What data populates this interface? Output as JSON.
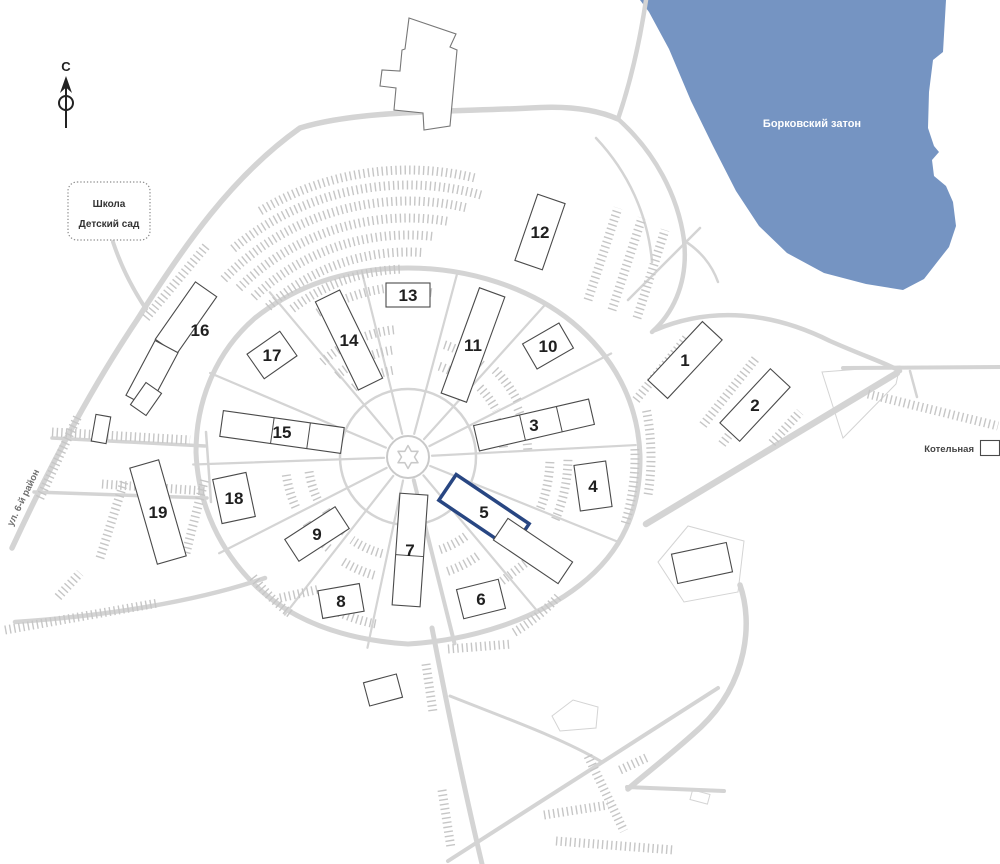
{
  "map": {
    "labels": {
      "water": "Борковский затон",
      "school_line1": "Школа",
      "school_line2": "Детский сад",
      "street": "ул. 6-й район",
      "boiler": "Котельная",
      "compass_north": "С"
    },
    "colors": {
      "water": "#7594c2",
      "road": "#d4d4d4",
      "parking": "#c6c6c6",
      "building_outline": "#4a4a4a",
      "highlight": "#284682",
      "number_text": "#1f1f1f",
      "water_label_text": "#ffffff"
    },
    "highlighted_building": "5",
    "buildings": [
      {
        "num": "1",
        "cx": 685,
        "cy": 360,
        "w": 80,
        "h": 27,
        "rot": -47
      },
      {
        "num": "2",
        "cx": 755,
        "cy": 405,
        "w": 74,
        "h": 27,
        "rot": -47
      },
      {
        "num": "3",
        "cx": 534,
        "cy": 425,
        "w": 118,
        "h": 26,
        "rot": -13,
        "segs": [
          0.4,
          0.72
        ]
      },
      {
        "num": "4",
        "cx": 593,
        "cy": 486,
        "w": 32,
        "h": 46,
        "rot": -8
      },
      {
        "num": "5",
        "cx": 484,
        "cy": 512,
        "w": 88,
        "h": 31,
        "rot": 34,
        "highlight": true
      },
      {
        "num": "",
        "cx": 533,
        "cy": 551,
        "w": 78,
        "h": 26,
        "rot": 34
      },
      {
        "num": "6",
        "cx": 481,
        "cy": 599,
        "w": 43,
        "h": 30,
        "rot": -14
      },
      {
        "num": "7",
        "cx": 410,
        "cy": 550,
        "w": 28,
        "h": 112,
        "rot": 4,
        "segsv": [
          0.55
        ]
      },
      {
        "num": "8",
        "cx": 341,
        "cy": 601,
        "w": 42,
        "h": 28,
        "rot": -10
      },
      {
        "num": "9",
        "cx": 317,
        "cy": 534,
        "w": 60,
        "h": 26,
        "rot": -33
      },
      {
        "num": "10",
        "cx": 548,
        "cy": 346,
        "w": 42,
        "h": 29,
        "rot": -30
      },
      {
        "num": "11",
        "cx": 473,
        "cy": 345,
        "w": 27,
        "h": 112,
        "rot": 20
      },
      {
        "num": "12",
        "cx": 540,
        "cy": 232,
        "w": 29,
        "h": 70,
        "rot": 19
      },
      {
        "num": "13",
        "cx": 408,
        "cy": 295,
        "w": 44,
        "h": 24,
        "rot": 0
      },
      {
        "num": "14",
        "cx": 349,
        "cy": 340,
        "w": 27,
        "h": 98,
        "rot": -26
      },
      {
        "num": "15",
        "cx": 282,
        "cy": 432,
        "w": 122,
        "h": 26,
        "rot": 8,
        "segs": [
          0.42,
          0.72
        ]
      },
      {
        "num": "16",
        "cx": 186,
        "cy": 318,
        "w": 70,
        "h": 26,
        "rot": -55,
        "lx": 200,
        "ly": 330
      },
      {
        "num": "",
        "cx": 152,
        "cy": 374,
        "w": 62,
        "h": 26,
        "rot": -62
      },
      {
        "num": "",
        "cx": 146,
        "cy": 399,
        "w": 27,
        "h": 19,
        "rot": -55
      },
      {
        "num": "17",
        "cx": 272,
        "cy": 355,
        "w": 40,
        "h": 30,
        "rot": -35
      },
      {
        "num": "18",
        "cx": 234,
        "cy": 498,
        "w": 34,
        "h": 45,
        "rot": -12
      },
      {
        "num": "19",
        "cx": 158,
        "cy": 512,
        "w": 30,
        "h": 100,
        "rot": -16
      },
      {
        "num": "",
        "cx": 101,
        "cy": 429,
        "w": 15,
        "h": 27,
        "rot": 10
      },
      {
        "num": "",
        "cx": 383,
        "cy": 690,
        "w": 34,
        "h": 24,
        "rot": -15
      },
      {
        "num": "",
        "cx": 702,
        "cy": 563,
        "w": 56,
        "h": 30,
        "rot": -12
      },
      {
        "num": "",
        "cx": 990,
        "cy": 448,
        "w": 19,
        "h": 15,
        "rot": 0,
        "name": "boiler-building"
      }
    ]
  }
}
